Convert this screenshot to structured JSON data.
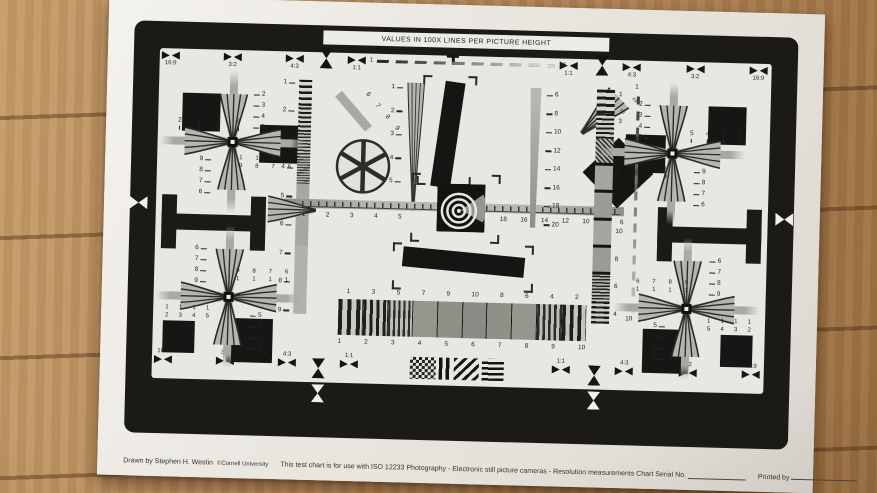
{
  "title": "VALUES IN 100X LINES PER PICTURE HEIGHT",
  "footer": {
    "credit": "Drawn by Stephen H. Westin",
    "org": "©Cornell University",
    "usage": "This test chart is for use with ISO 12233 Photography - Electronic still picture cameras - Resolution measurements Chart Serial No.",
    "printed_by": "Printed by"
  },
  "aspect": {
    "top_left": [
      "16:9",
      "3:2",
      "4:3",
      "1:1"
    ],
    "top_right": [
      "1:1",
      "4:3",
      "3:2",
      "16:9"
    ],
    "bottom_left": [
      "16:9",
      "3:2",
      "4:3",
      "1:1"
    ],
    "bottom_right": [
      "1:1",
      "4:3",
      "3:2",
      "16:9"
    ]
  },
  "fade_line": {
    "start": "1",
    "end": "10"
  },
  "left_ruler": [
    "1",
    "2",
    "3",
    "4",
    "5",
    "6",
    "7",
    "8",
    "9"
  ],
  "diag_labels": [
    "6",
    "7",
    "8",
    "9"
  ],
  "mid_ruler": [
    "1",
    "2",
    "3",
    "4",
    "5",
    "6"
  ],
  "right_wedge_ruler": [
    "6",
    "8",
    "10",
    "12",
    "14",
    "16",
    "18",
    "20"
  ],
  "fan_labels": [
    "5",
    "4",
    "3",
    "2"
  ],
  "center_ruler": {
    "left": [
      "1",
      "2",
      "3",
      "4",
      "5"
    ],
    "right": [
      "18",
      "16",
      "14",
      "12",
      "10",
      "8",
      "6"
    ]
  },
  "right_sweep": {
    "labels": [
      "1",
      "3",
      "5",
      "7",
      "9",
      "10",
      "8",
      "6",
      "4"
    ],
    "dash_start": "1",
    "dash_end": "10"
  },
  "hsweep": {
    "top": [
      "1",
      "3",
      "5",
      "7",
      "9",
      "10",
      "8",
      "6",
      "4",
      "2"
    ],
    "bottom": [
      "1",
      "2",
      "3",
      "4",
      "5",
      "6",
      "7",
      "8",
      "9",
      "10"
    ]
  },
  "corners": {
    "tl": {
      "v_top": [
        "2",
        "3",
        "4",
        "5"
      ],
      "h_outer": [
        "2",
        "3",
        "4",
        "5"
      ],
      "v_bottom": [
        "9",
        "8",
        "7",
        "6"
      ],
      "rows_inner_1": [
        "1",
        "1",
        "1",
        "1"
      ],
      "rows_inner_2": [
        "9",
        "8",
        "7",
        "6"
      ]
    },
    "tr": {
      "v_top": [
        "2",
        "3",
        "4",
        "5"
      ],
      "h_outer": [
        "5",
        "4",
        "3",
        "2"
      ],
      "v_bottom": [
        "9",
        "8",
        "7",
        "6"
      ],
      "rows_inner_1": [
        "1",
        "1",
        "1",
        "1"
      ],
      "rows_inner_2": [
        "6",
        "7",
        "8",
        "9"
      ]
    },
    "bl": {
      "v_top": [
        "6",
        "7",
        "8",
        "9"
      ],
      "rows_inner_1": [
        "9",
        "8",
        "7",
        "6"
      ],
      "rows_inner_2": [
        "1",
        "1",
        "1",
        "1"
      ],
      "v_bottom": [
        "5",
        "4",
        "3",
        "2"
      ],
      "rows_outer_1": [
        "1",
        "1",
        "1",
        "1"
      ],
      "rows_outer_2": [
        "2",
        "3",
        "4",
        "5"
      ]
    },
    "br": {
      "v_top": [
        "6",
        "7",
        "8",
        "9"
      ],
      "rows_inner_1": [
        "6",
        "7",
        "8",
        "9"
      ],
      "rows_inner_2": [
        "1",
        "1",
        "1",
        "1"
      ],
      "v_bottom": [
        "5",
        "4",
        "3",
        "2"
      ],
      "rows_outer_1": [
        "1",
        "1",
        "1",
        "1"
      ],
      "rows_outer_2": [
        "5",
        "4",
        "3",
        "2"
      ]
    }
  }
}
